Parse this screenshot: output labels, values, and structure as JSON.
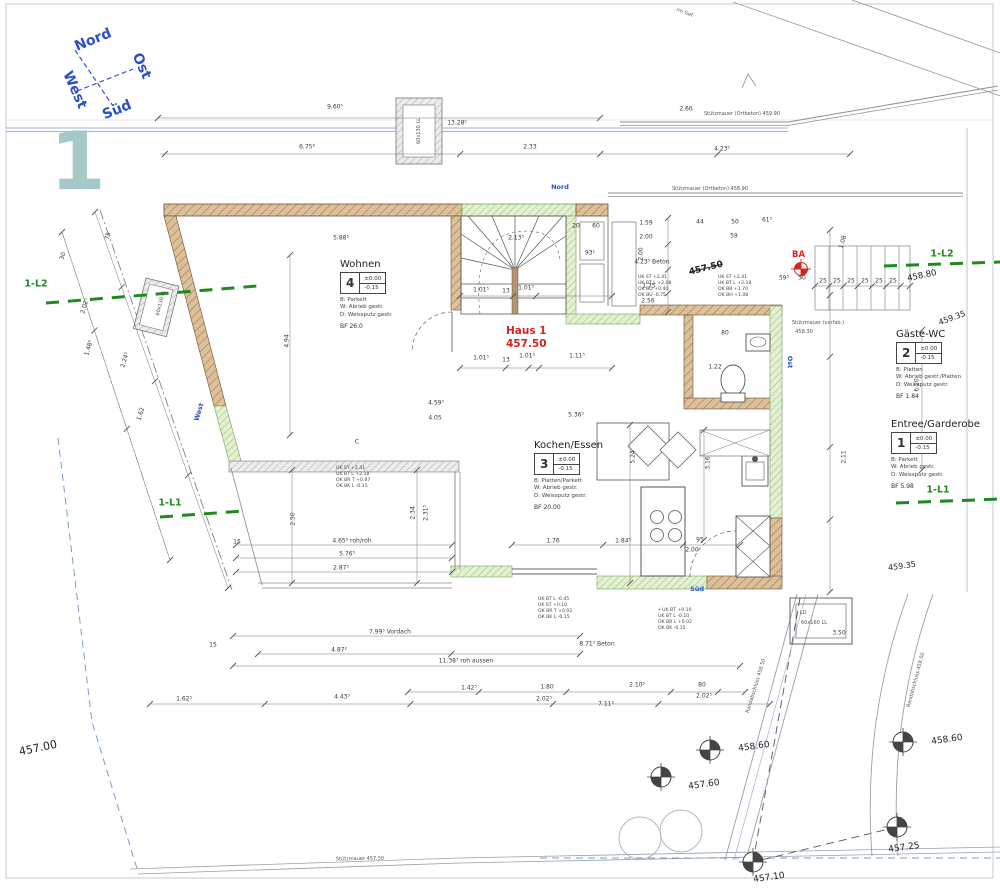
{
  "meta": {
    "sheet_number": "1"
  },
  "colors": {
    "wall_brown": "#dcc09c",
    "insulation_green": "#e4f0d2",
    "terrace_gray": "#ececec",
    "marker_green": "#1f8a1f",
    "accent_red": "#d42525",
    "blue": "#2b50c8",
    "teal": "#a6c8c8"
  },
  "compass": {
    "north": "Nord",
    "east": "Ost",
    "south": "Süd",
    "west": "West"
  },
  "house_marker": {
    "line1": "Haus 1",
    "line2": "457.50"
  },
  "ba_label": "BA",
  "crossed_level": "457.50",
  "rooms": {
    "wohnen": {
      "title": "Wohnen",
      "number": "4",
      "level1": "±0.00",
      "level2": "-0.15",
      "fin1": "B:  Parkett",
      "fin2": "W:  Abrieb gestr.",
      "fin3": "D:  Weissputz gestr.",
      "bf": "BF  26.0"
    },
    "kochen": {
      "title": "Kochen/Essen",
      "number": "3",
      "level1": "±0.00",
      "level2": "-0.15",
      "fin1": "B:  Platten/Parkett",
      "fin2": "W:  Abrieb gestr.",
      "fin3": "D:  Weissputz gestr.",
      "bf": "BF  20.00"
    },
    "gaeste": {
      "title": "Gäste-WC",
      "number": "2",
      "level1": "±0.00",
      "level2": "-0.15",
      "fin1": "B:  Platten",
      "fin2": "W:  Abrieb gestr./Platten",
      "fin3": "D:  Weissputz gestr.",
      "bf": "BF  1.84"
    },
    "entree": {
      "title": "Entree/Garderobe",
      "number": "1",
      "level1": "±0.00",
      "level2": "-0.15",
      "fin1": "B:  Parkett",
      "fin2": "W:  Abrieb gestr.",
      "fin3": "D:  Weissputz gestr.",
      "bf": "BF  5.98"
    }
  },
  "facade_labels": [
    {
      "t": "Nord",
      "x": 560,
      "y": 187
    },
    {
      "t": "Ost",
      "x": 790,
      "y": 362,
      "r": 90
    },
    {
      "t": "Süd",
      "x": 697,
      "y": 589
    },
    {
      "t": "West",
      "x": 199,
      "y": 412,
      "r": -73
    }
  ],
  "section_markers": [
    {
      "t": "1-L2",
      "x": 36,
      "y": 284
    },
    {
      "t": "1-L2",
      "x": 942,
      "y": 254
    },
    {
      "t": "1-L1",
      "x": 170,
      "y": 503
    },
    {
      "t": "1-L1",
      "x": 938,
      "y": 490
    }
  ],
  "retaining_labels": [
    {
      "t": "Stützmauer (Ortbeton) 459.90",
      "x": 742,
      "y": 114
    },
    {
      "t": "Stützmauer (Ortbeton) 458.90",
      "x": 710,
      "y": 189
    },
    {
      "t": "Stützmauer (vorfab.)",
      "x": 818,
      "y": 323
    },
    {
      "t": "458.30",
      "x": 804,
      "y": 332
    },
    {
      "t": "Stützmauer 457.50",
      "x": 360,
      "y": 859,
      "r": -1
    }
  ],
  "spot_heights": [
    {
      "t": "457.00",
      "x": 38,
      "y": 748,
      "r": -12,
      "s": 11
    },
    {
      "t": "458.80",
      "x": 922,
      "y": 276,
      "r": -12,
      "s": 8.5
    },
    {
      "t": "459.35",
      "x": 952,
      "y": 318,
      "r": -20,
      "s": 8
    },
    {
      "t": "459.35",
      "x": 902,
      "y": 566,
      "r": -8,
      "s": 8
    }
  ],
  "survey_points": [
    {
      "t": "458.60",
      "x": 710,
      "y": 750,
      "lx": 740,
      "ly": 747,
      "r": -8
    },
    {
      "t": "457.60",
      "x": 661,
      "y": 777,
      "lx": 690,
      "ly": 785,
      "r": -8
    },
    {
      "t": "458.60",
      "x": 903,
      "y": 742,
      "lx": 933,
      "ly": 740,
      "r": -8
    },
    {
      "t": "457.25",
      "x": 897,
      "y": 827,
      "lx": 890,
      "ly": 848,
      "r": -8
    },
    {
      "t": "457.10",
      "x": 753,
      "y": 862,
      "lx": 755,
      "ly": 878,
      "r": -8
    }
  ],
  "path_labels": [
    {
      "t": "Randabschluss 458.50",
      "x": 756,
      "y": 686,
      "r": -73
    },
    {
      "t": "Randabschluss 458.50",
      "x": 916,
      "y": 680,
      "r": -75
    },
    {
      "t": "rm Gef.",
      "x": 685,
      "y": 13,
      "r": 20
    }
  ],
  "lightwell_labels": [
    {
      "t": "60x130 LL",
      "x": 419,
      "y": 131,
      "r": -90
    },
    {
      "t": "60x130 LL",
      "x": 161,
      "y": 303,
      "r": -76
    },
    {
      "t": "LD",
      "x": 803,
      "y": 613
    },
    {
      "t": "60x160 LL",
      "x": 814,
      "y": 623
    }
  ],
  "misc_labels": [
    {
      "t": "C",
      "x": 357,
      "y": 442
    }
  ],
  "window_notes": [
    {
      "x": 336,
      "y": 466,
      "lines": [
        "UK ST  +2.41",
        "UK BT L  +2.18",
        "OK BR T  +0.87",
        "OK BK L  -0.15"
      ]
    },
    {
      "x": 638,
      "y": 275,
      "lines": [
        "UK ST  +2.41",
        "UK BT L  +2.08",
        "OK BO  +0.40",
        "OK BU  -0.75"
      ]
    },
    {
      "x": 718,
      "y": 275,
      "lines": [
        "UK ST  +2.41",
        "UK BT L  +2.18",
        "OK BB  +1.70",
        "OK BH  +1.08"
      ]
    },
    {
      "x": 538,
      "y": 597,
      "lines": [
        "UK BT L  -0.45",
        "UK ST  +0.10",
        "OK BR T  +0.02",
        "OK BK L  -0.15"
      ]
    },
    {
      "x": 658,
      "y": 608,
      "lines": [
        "• UK BT  +0.10",
        "UK BT L  -0.10",
        "OK BR L  +0.02",
        "OK BK  -0.15"
      ]
    }
  ],
  "dims": [
    {
      "t": "9.60⁵",
      "x": 335,
      "y": 107
    },
    {
      "t": "13.28⁵",
      "x": 457,
      "y": 123
    },
    {
      "t": "2.66",
      "x": 686,
      "y": 109
    },
    {
      "t": "6.75⁸",
      "x": 307,
      "y": 147
    },
    {
      "t": "2.33",
      "x": 530,
      "y": 147
    },
    {
      "t": "4.23⁵",
      "x": 722,
      "y": 149
    },
    {
      "t": "5.88⁵",
      "x": 341,
      "y": 238
    },
    {
      "t": "2.13⁵",
      "x": 516,
      "y": 238
    },
    {
      "t": "20",
      "x": 576,
      "y": 226
    },
    {
      "t": "60",
      "x": 596,
      "y": 226
    },
    {
      "t": "93¹",
      "x": 590,
      "y": 253
    },
    {
      "t": "1.01⁵",
      "x": 481,
      "y": 290
    },
    {
      "t": "13",
      "x": 506,
      "y": 291
    },
    {
      "t": "1.01⁵",
      "x": 526,
      "y": 288
    },
    {
      "t": "1.01⁵",
      "x": 481,
      "y": 358
    },
    {
      "t": "13",
      "x": 506,
      "y": 360
    },
    {
      "t": "1.01⁵",
      "x": 527,
      "y": 356
    },
    {
      "t": "1.11⁵",
      "x": 577,
      "y": 356
    },
    {
      "t": "1.59",
      "x": 646,
      "y": 223
    },
    {
      "t": "2.00",
      "x": 646,
      "y": 237
    },
    {
      "t": "4.23⁵ Beton",
      "x": 652,
      "y": 262
    },
    {
      "t": "1.75",
      "x": 649,
      "y": 286
    },
    {
      "t": "2.56",
      "x": 648,
      "y": 301
    },
    {
      "t": "44",
      "x": 700,
      "y": 222
    },
    {
      "t": "50",
      "x": 735,
      "y": 222
    },
    {
      "t": "61⁵",
      "x": 767,
      "y": 220
    },
    {
      "t": "59",
      "x": 734,
      "y": 236
    },
    {
      "t": "59⁵",
      "x": 784,
      "y": 278
    },
    {
      "t": "50",
      "x": 802,
      "y": 278
    },
    {
      "t": "25",
      "x": 823,
      "y": 281
    },
    {
      "t": "25",
      "x": 837,
      "y": 281
    },
    {
      "t": "25",
      "x": 851,
      "y": 281
    },
    {
      "t": "25",
      "x": 865,
      "y": 281
    },
    {
      "t": "25",
      "x": 879,
      "y": 281
    },
    {
      "t": "25",
      "x": 893,
      "y": 281
    },
    {
      "t": "1.08",
      "x": 843,
      "y": 242,
      "r": -73
    },
    {
      "t": "4.94",
      "x": 287,
      "y": 341,
      "r": -90
    },
    {
      "t": "2.50",
      "x": 293,
      "y": 519,
      "r": -90
    },
    {
      "t": "2.34",
      "x": 413,
      "y": 513,
      "r": -90
    },
    {
      "t": "2.31⁵",
      "x": 426,
      "y": 513,
      "r": -90
    },
    {
      "t": "2.00",
      "x": 641,
      "y": 254,
      "r": -90
    },
    {
      "t": "5.24",
      "x": 633,
      "y": 457,
      "r": -90
    },
    {
      "t": "3.16",
      "x": 708,
      "y": 463,
      "r": -90
    },
    {
      "t": "6.20",
      "x": 917,
      "y": 385,
      "r": -90
    },
    {
      "t": "2.11",
      "x": 844,
      "y": 457,
      "r": -90
    },
    {
      "t": "4.59⁵",
      "x": 436,
      "y": 403
    },
    {
      "t": "4.05",
      "x": 435,
      "y": 418
    },
    {
      "t": "5.36⁵",
      "x": 576,
      "y": 415
    },
    {
      "t": "95",
      "x": 700,
      "y": 540
    },
    {
      "t": "2.00",
      "x": 692,
      "y": 550
    },
    {
      "t": "1.76",
      "x": 553,
      "y": 541
    },
    {
      "t": "1.84⁵",
      "x": 623,
      "y": 541
    },
    {
      "t": "4.65⁵  roh/roh",
      "x": 352,
      "y": 541
    },
    {
      "t": "5.76⁵",
      "x": 347,
      "y": 554
    },
    {
      "t": "2.87⁵",
      "x": 341,
      "y": 568
    },
    {
      "t": "15",
      "x": 237,
      "y": 542
    },
    {
      "t": "7.99⁵  Vordach",
      "x": 390,
      "y": 632
    },
    {
      "t": "4.87²",
      "x": 339,
      "y": 650
    },
    {
      "t": "11.38⁷  roh aussen",
      "x": 466,
      "y": 661
    },
    {
      "t": "8.71⁵  Beton",
      "x": 597,
      "y": 644
    },
    {
      "t": "3.50",
      "x": 839,
      "y": 633
    },
    {
      "t": "1.42⁵",
      "x": 469,
      "y": 688
    },
    {
      "t": "1.80",
      "x": 547,
      "y": 687
    },
    {
      "t": "2.10⁵",
      "x": 637,
      "y": 685
    },
    {
      "t": "80",
      "x": 702,
      "y": 685
    },
    {
      "t": "2.02⁵",
      "x": 544,
      "y": 699
    },
    {
      "t": "7.11⁵",
      "x": 606,
      "y": 704
    },
    {
      "t": "2.02⁵",
      "x": 704,
      "y": 696
    },
    {
      "t": "1.62⁵",
      "x": 184,
      "y": 699
    },
    {
      "t": "4.43⁵",
      "x": 342,
      "y": 697
    },
    {
      "t": "15",
      "x": 213,
      "y": 645
    },
    {
      "t": "1.22",
      "x": 715,
      "y": 367
    },
    {
      "t": "80",
      "x": 725,
      "y": 333
    },
    {
      "t": "75",
      "x": 108,
      "y": 236,
      "r": -73
    },
    {
      "t": "30",
      "x": 63,
      "y": 256,
      "r": -73
    },
    {
      "t": "2.02⁵",
      "x": 85,
      "y": 306,
      "r": -73
    },
    {
      "t": "1.48⁵",
      "x": 89,
      "y": 348,
      "r": -73
    },
    {
      "t": "2.24⁵",
      "x": 125,
      "y": 360,
      "r": -73
    },
    {
      "t": "1.62",
      "x": 141,
      "y": 414,
      "r": -73
    }
  ]
}
